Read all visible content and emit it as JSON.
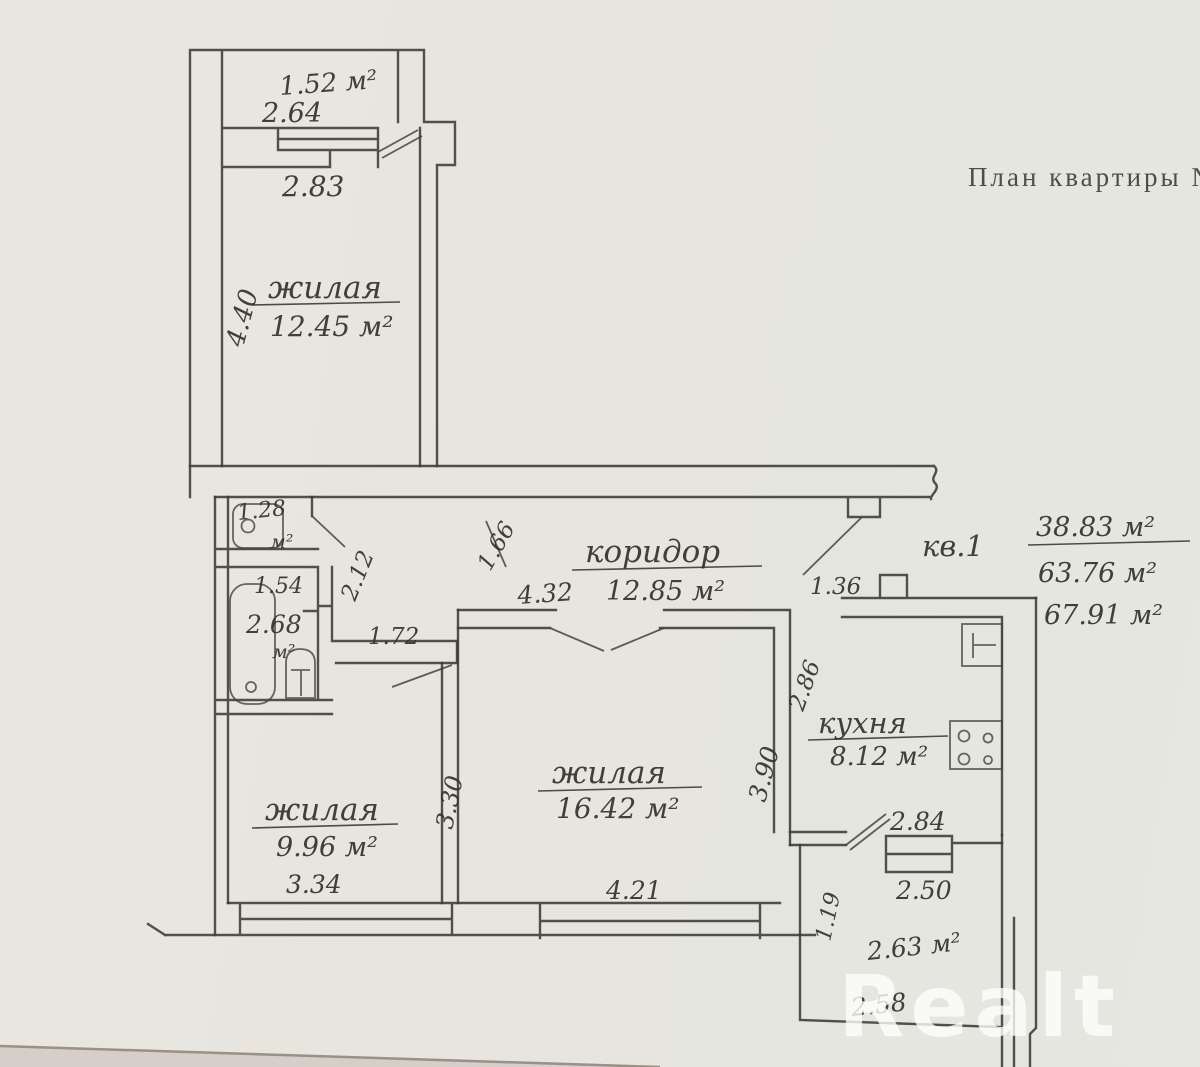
{
  "title": "План квартиры №",
  "watermark": "Realt",
  "apartment": {
    "label": "кв.1",
    "living_area": "38.83 м²",
    "usable_area": "63.76 м²",
    "total_area": "67.91 м²"
  },
  "rooms": {
    "balcony": {
      "area": "1.52 м²",
      "window_width": "2.64",
      "door_wall_width": "2.83"
    },
    "room1": {
      "name": "жилая",
      "area": "12.45 м²",
      "depth": "4.40"
    },
    "corridor": {
      "name": "коридор",
      "area": "12.85 м²",
      "entry_door": "1.36",
      "side_dim": "1.66",
      "top_dim": "4.32"
    },
    "wc": {
      "area": "1.28",
      "unit": "м²"
    },
    "bathroom": {
      "width": "1.54",
      "area": "2.68",
      "unit": "м²",
      "door_width": "1.72",
      "niche_dim": "2.12"
    },
    "room2": {
      "name": "жилая",
      "area": "16.42 м²",
      "width": "4.21",
      "depth": "3.90",
      "wall_dim": "3.30"
    },
    "room3": {
      "name": "жилая",
      "area": "9.96 м²",
      "width": "3.34"
    },
    "kitchen": {
      "name": "кухня",
      "area": "8.12 м²",
      "depth": "2.86"
    },
    "loggia": {
      "top_width": "2.84",
      "width": "2.50",
      "area": "2.63 м²",
      "bottom_width": "2.58",
      "side_dim": "1.19"
    }
  },
  "colors": {
    "paper": "#e8e5df",
    "ink": "#3d3a35",
    "typed_text": "#504d47",
    "watermark": "#ffffff"
  }
}
